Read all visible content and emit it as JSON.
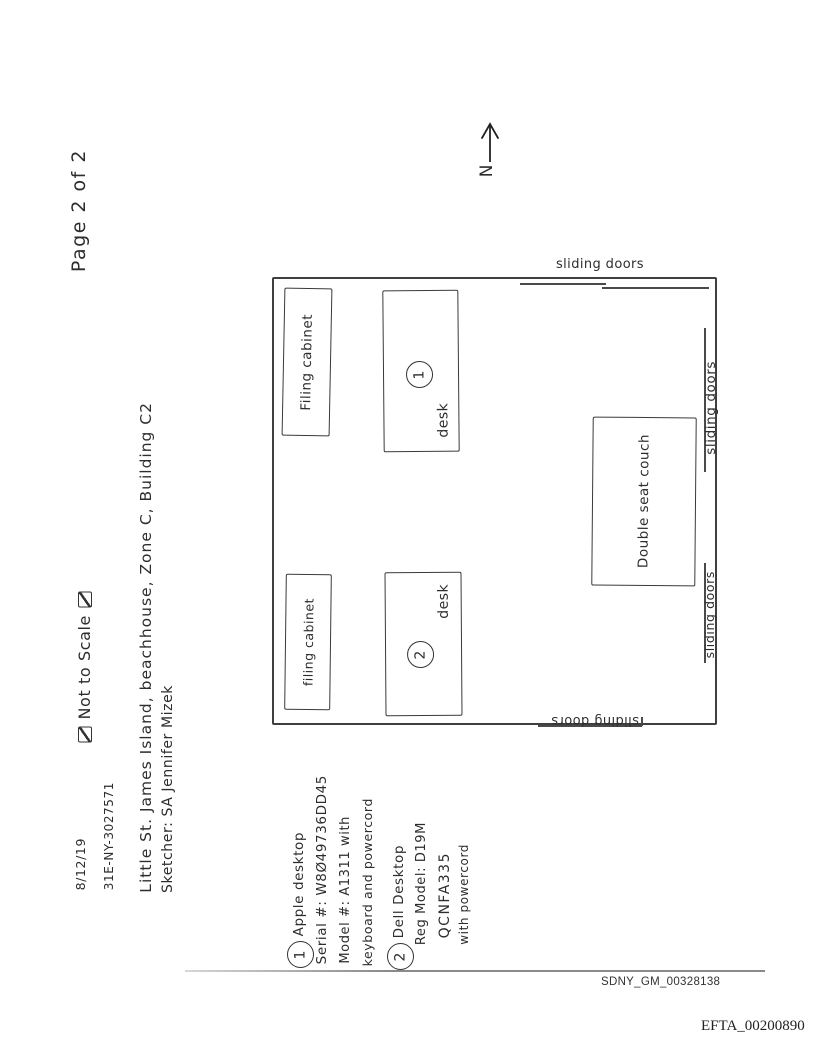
{
  "document": {
    "header": {
      "date": "8/12/19",
      "case_number": "31E-NY-3027571",
      "location_line": "Little St. James Island, beachhouse, Zone C, Building C2",
      "sketcher_line": "Sketcher: SA Jennifer Mizek",
      "not_to_scale": "Not to Scale",
      "page_label": "Page 2 of 2"
    },
    "compass": {
      "north_label": "N"
    },
    "room": {
      "furniture": [
        {
          "label": "Filing cabinet"
        },
        {
          "label": "desk",
          "marker": "1"
        },
        {
          "label": "filing cabinet"
        },
        {
          "label": "desk",
          "marker": "2"
        },
        {
          "label": "Double seat couch"
        }
      ],
      "door_labels": {
        "top": "sliding doors",
        "right_upper": "sliding doors",
        "right_lower": "sliding doors",
        "bottom": "sliding doors"
      }
    },
    "legend": {
      "items": [
        {
          "marker": "1",
          "lines": [
            "Apple desktop",
            "Serial #: W8Ø49736DD45",
            "Model #: A1311 with",
            "keyboard and powercord"
          ]
        },
        {
          "marker": "2",
          "lines": [
            "Dell Desktop",
            "Reg Model: D19M",
            "QCNFA335",
            "with powercord"
          ]
        }
      ]
    },
    "stamps": {
      "bates_sdny": "SDNY_GM_00328138",
      "bates_efta": "EFTA_00200890"
    },
    "colors": {
      "pencil": "#2d2d2d",
      "scan_line": "#8a8a8a"
    }
  }
}
